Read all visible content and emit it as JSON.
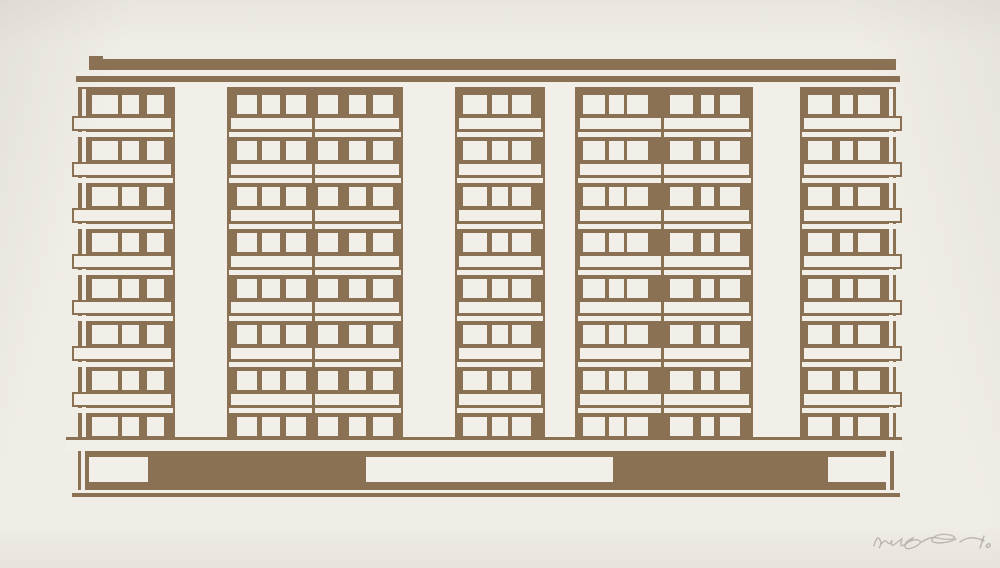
{
  "artwork": {
    "type": "screenprint",
    "subject": "Modernist apartment block facade print on cream paper",
    "palette": {
      "paper": "#f0ede6",
      "ink": "#8a7154",
      "white": "#f2efe8",
      "pencil": "#968f84"
    },
    "signature": {
      "present": true,
      "legible": false,
      "medium": "pencil",
      "position": "bottom-right",
      "edition_mark": true
    }
  },
  "canvas": {
    "width": 1000,
    "height": 568
  },
  "building": {
    "roof": {
      "left_cap": [
        89,
        56,
        14,
        14
      ],
      "bar": [
        89,
        59,
        805,
        11
      ],
      "right_cap": [
        881,
        59,
        15,
        21
      ]
    },
    "parapet": {
      "band": [
        76,
        70,
        824,
        6
      ],
      "line": [
        76,
        76,
        824,
        6
      ],
      "top_strip": [
        78,
        82,
        818,
        5
      ]
    },
    "facade": [
      78,
      82,
      818,
      355
    ],
    "edge_slits": [
      [
        82,
        89,
        4,
        348
      ],
      [
        889,
        89,
        4,
        348
      ]
    ],
    "columns": {
      "y": 87,
      "h": 350,
      "x_w": [
        [
          175,
          52
        ],
        [
          403,
          52
        ],
        [
          545,
          30
        ],
        [
          753,
          47
        ]
      ]
    },
    "floors": {
      "tops": [
        95,
        141,
        187,
        233,
        279,
        325,
        371,
        417
      ],
      "window_h": 19,
      "band_dy": 21,
      "band_h": 15,
      "strip_dy": 37,
      "strip_h": 5
    },
    "sections": [
      {
        "name": "left-end-bay",
        "band": [
          72,
          101
        ],
        "strip": [
          78,
          95
        ],
        "windows": [
          [
            92,
            26
          ],
          [
            122,
            17
          ],
          [
            147,
            17
          ]
        ],
        "divider": null
      },
      {
        "name": "bay-a",
        "band": [
          229,
          172
        ],
        "strip": [
          229,
          172
        ],
        "windows": [
          [
            237,
            20
          ],
          [
            262,
            18
          ],
          [
            286,
            20
          ],
          [
            318,
            20
          ],
          [
            349,
            17
          ],
          [
            373,
            20
          ]
        ],
        "divider": 312
      },
      {
        "name": "bay-b",
        "band": [
          457,
          86
        ],
        "strip": [
          457,
          86
        ],
        "windows": [
          [
            463,
            24
          ],
          [
            492,
            16
          ],
          [
            512,
            19
          ]
        ],
        "divider": null
      },
      {
        "name": "bay-c",
        "band": [
          578,
          173
        ],
        "strip": [
          578,
          173
        ],
        "windows": [
          [
            583,
            22
          ],
          [
            609,
            15
          ],
          [
            627,
            21
          ],
          [
            670,
            23
          ],
          [
            701,
            13
          ],
          [
            720,
            20
          ]
        ],
        "divider": 661
      },
      {
        "name": "right-end-bay",
        "band": [
          802,
          100
        ],
        "strip": [
          802,
          94
        ],
        "windows": [
          [
            808,
            24
          ],
          [
            840,
            13
          ],
          [
            858,
            22
          ]
        ],
        "divider": null
      }
    ],
    "divider_y": [
      87,
      350
    ],
    "slab": [
      66,
      437,
      836,
      14
    ],
    "base": {
      "rect": [
        78,
        451,
        816,
        39
      ],
      "openings_y": [
        457,
        25
      ],
      "openings": [
        [
          89,
          59
        ],
        [
          366,
          247
        ],
        [
          828,
          59
        ]
      ],
      "slits": [
        [
          81,
          451,
          4,
          39
        ],
        [
          886,
          451,
          4,
          39
        ]
      ],
      "bottom_slit": [
        78,
        490,
        816,
        3
      ],
      "ground_line": [
        72,
        493,
        828,
        4
      ]
    }
  }
}
